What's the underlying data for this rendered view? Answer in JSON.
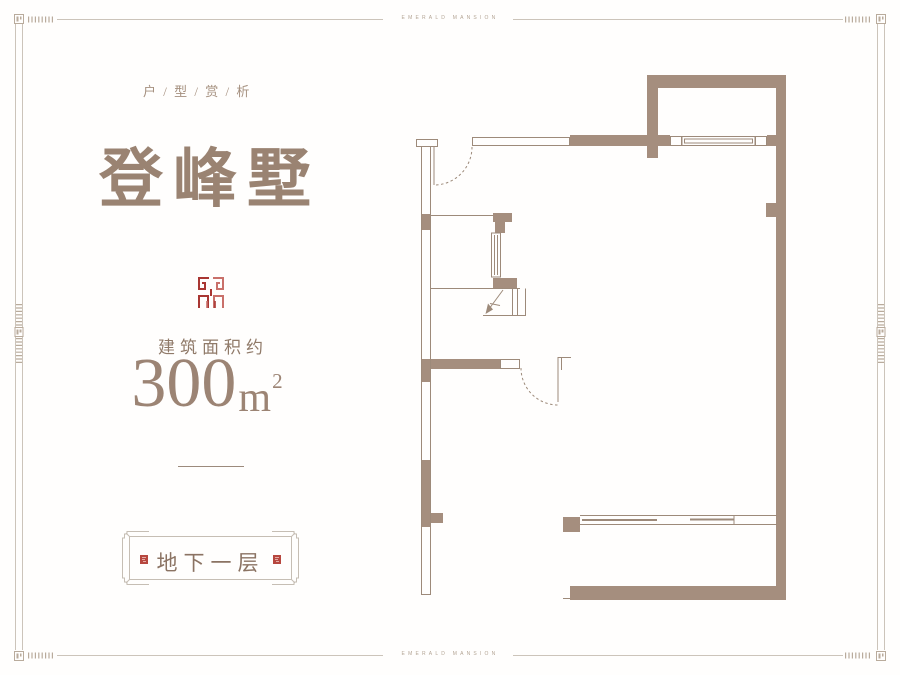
{
  "border": {
    "top_text": "EMERALD MANSION",
    "bottom_text": "EMERALD MANSION"
  },
  "left_panel": {
    "category": "户 / 型 / 赏 / 析",
    "title": "登峰墅",
    "area_label": "建筑面积约",
    "area_value": "300",
    "area_unit": "m",
    "area_exponent": "2",
    "floor_plaque_label": "地下一层"
  },
  "icons": {
    "seal_logo": "seal-logo-icon",
    "plaque_seals": "mini-seal-icon",
    "stairs": "stairs-down-arrow"
  },
  "colors": {
    "wall_brown": "#a58e7e",
    "plan_line_brown": "#9d8a7a",
    "text_brown": "#97806f",
    "seal_red": "#a93632",
    "frame_gray": "#ccc4ba"
  }
}
